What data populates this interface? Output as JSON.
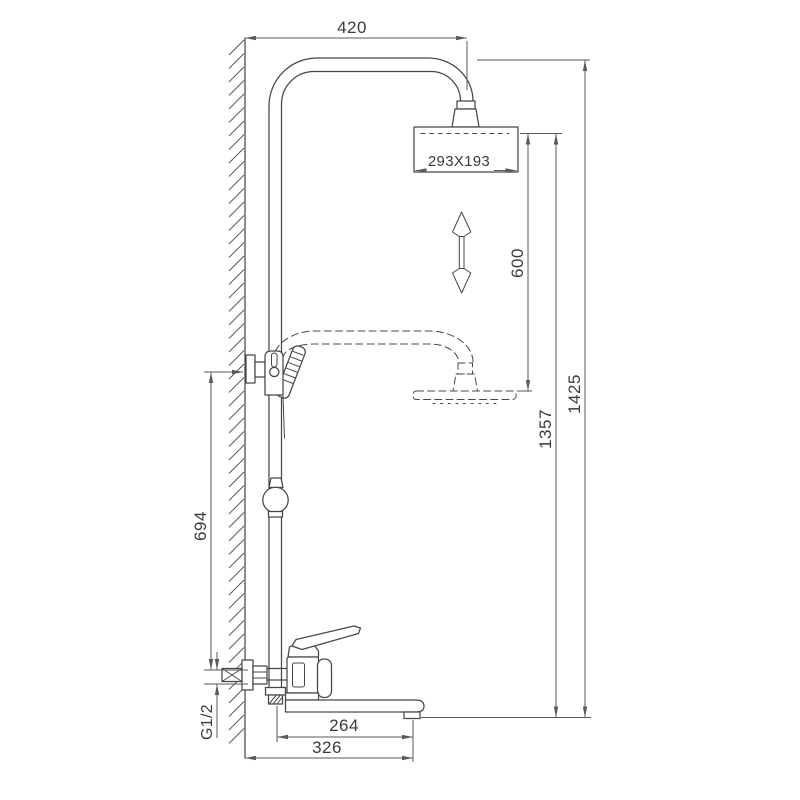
{
  "drawing": {
    "type": "technical-dimension-drawing",
    "subject": "wall-mounted shower column with rain head, hand shower and bath mixer spout",
    "colors": {
      "background": "#ffffff",
      "outline": "#474747",
      "dimension": "#5a5a5a",
      "text": "#3b3b3b"
    },
    "labels": {
      "arm_reach": "420",
      "head_size": "293X193",
      "height_adjustment": "600",
      "total_height": "1425",
      "head_height": "1357",
      "bracket_height": "694",
      "connection_thread": "G1/2",
      "spout_reach": "264",
      "spout_overall_reach": "326"
    }
  }
}
